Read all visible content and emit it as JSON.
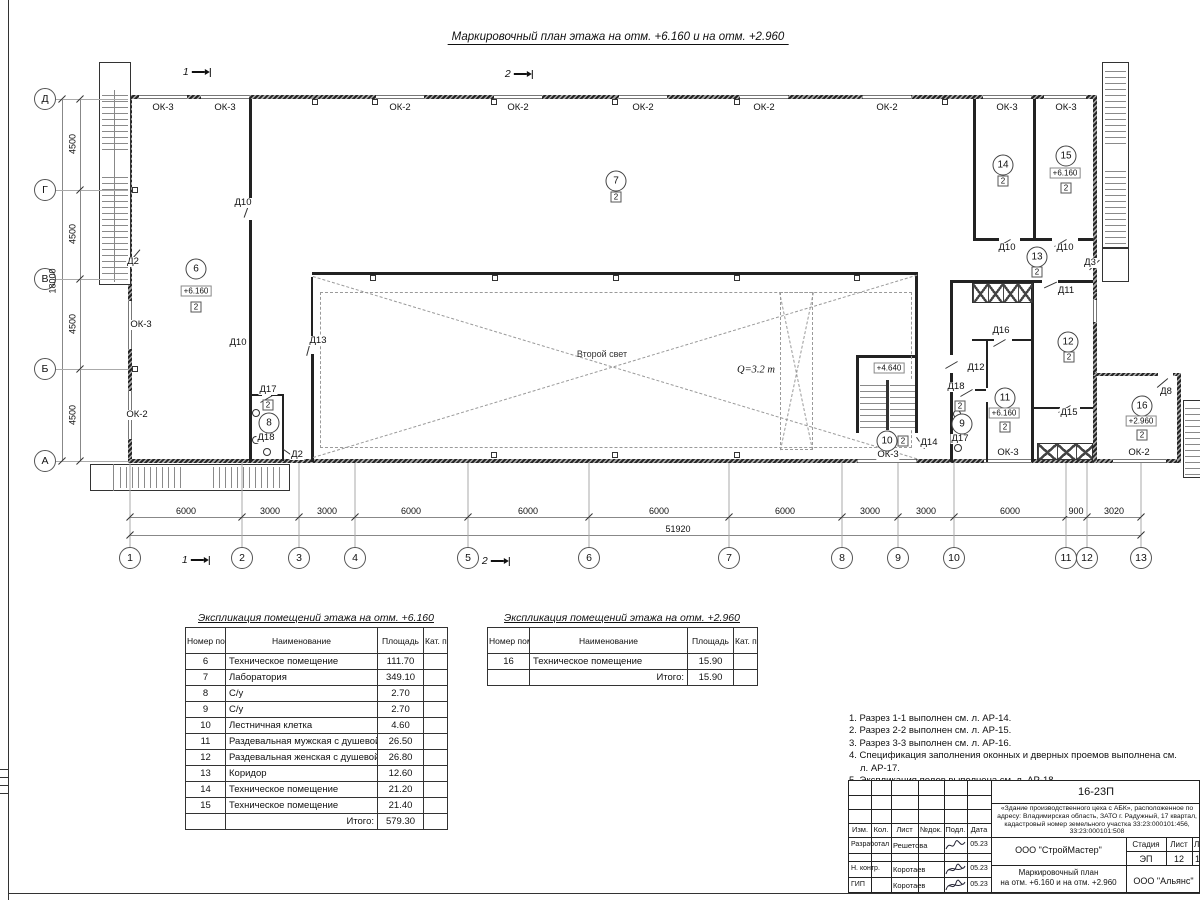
{
  "title": "Маркировочный план этажа на отм. +6.160 и на отм. +2.960",
  "colors": {
    "ink": "#1a1a1a",
    "thin_line": "#888",
    "dashed": "#9a9a9a"
  },
  "plan": {
    "col_axes": [
      {
        "label": "1",
        "x": 130
      },
      {
        "label": "2",
        "x": 242
      },
      {
        "label": "3",
        "x": 299
      },
      {
        "label": "4",
        "x": 355
      },
      {
        "label": "5",
        "x": 468
      },
      {
        "label": "6",
        "x": 589
      },
      {
        "label": "7",
        "x": 729
      },
      {
        "label": "8",
        "x": 842
      },
      {
        "label": "9",
        "x": 898
      },
      {
        "label": "10",
        "x": 954
      },
      {
        "label": "11",
        "x": 1066
      },
      {
        "label": "12",
        "x": 1087
      },
      {
        "label": "13",
        "x": 1141
      }
    ],
    "row_axes": [
      {
        "label": "Д",
        "y": 99
      },
      {
        "label": "Г",
        "y": 190
      },
      {
        "label": "В",
        "y": 279
      },
      {
        "label": "Б",
        "y": 369
      },
      {
        "label": "А",
        "y": 461
      }
    ],
    "dims_bottom": [
      {
        "text": "6000",
        "x": 186
      },
      {
        "text": "3000",
        "x": 270
      },
      {
        "text": "3000",
        "x": 327
      },
      {
        "text": "6000",
        "x": 411
      },
      {
        "text": "6000",
        "x": 528
      },
      {
        "text": "6000",
        "x": 659
      },
      {
        "text": "6000",
        "x": 785
      },
      {
        "text": "3000",
        "x": 870
      },
      {
        "text": "3000",
        "x": 926
      },
      {
        "text": "6000",
        "x": 1010
      },
      {
        "text": "900",
        "x": 1076
      },
      {
        "text": "3020",
        "x": 1114
      }
    ],
    "dim_total": {
      "text": "51920",
      "x": 678
    },
    "dims_left": [
      {
        "text": "4500",
        "y": 144
      },
      {
        "text": "4500",
        "y": 234
      },
      {
        "text": "4500",
        "y": 324
      },
      {
        "text": "4500",
        "y": 415
      }
    ],
    "dim_left_total": {
      "text": "18000",
      "y": 281
    },
    "window_labels": [
      {
        "t": "ОК-3",
        "x": 163,
        "y": 108
      },
      {
        "t": "ОК-3",
        "x": 225,
        "y": 108
      },
      {
        "t": "ОК-2",
        "x": 400,
        "y": 108
      },
      {
        "t": "ОК-2",
        "x": 518,
        "y": 108
      },
      {
        "t": "ОК-2",
        "x": 643,
        "y": 108
      },
      {
        "t": "ОК-2",
        "x": 764,
        "y": 108
      },
      {
        "t": "ОК-2",
        "x": 887,
        "y": 108
      },
      {
        "t": "ОК-3",
        "x": 1007,
        "y": 108
      },
      {
        "t": "ОК-3",
        "x": 1066,
        "y": 108
      },
      {
        "t": "ОК-3",
        "x": 141,
        "y": 325
      },
      {
        "t": "ОК-2",
        "x": 137,
        "y": 415
      },
      {
        "t": "ОК-3",
        "x": 888,
        "y": 455
      },
      {
        "t": "ОК-3",
        "x": 1008,
        "y": 453
      },
      {
        "t": "ОК-2",
        "x": 1139,
        "y": 453
      }
    ],
    "door_labels": [
      {
        "t": "Д2",
        "x": 133,
        "y": 262
      },
      {
        "t": "Д10",
        "x": 243,
        "y": 203
      },
      {
        "t": "Д10",
        "x": 238,
        "y": 343
      },
      {
        "t": "Д13",
        "x": 318,
        "y": 341
      },
      {
        "t": "Д17",
        "x": 268,
        "y": 390
      },
      {
        "t": "Д18",
        "x": 266,
        "y": 438
      },
      {
        "t": "Д2",
        "x": 297,
        "y": 455
      },
      {
        "t": "Д14",
        "x": 929,
        "y": 443
      },
      {
        "t": "Д18",
        "x": 956,
        "y": 387
      },
      {
        "t": "Д17",
        "x": 960,
        "y": 439
      },
      {
        "t": "Д12",
        "x": 976,
        "y": 368
      },
      {
        "t": "Д16",
        "x": 1001,
        "y": 331
      },
      {
        "t": "Д11",
        "x": 1066,
        "y": 291
      },
      {
        "t": "Д10",
        "x": 1007,
        "y": 248
      },
      {
        "t": "Д10",
        "x": 1065,
        "y": 248
      },
      {
        "t": "Д3",
        "x": 1090,
        "y": 263
      },
      {
        "t": "Д15",
        "x": 1069,
        "y": 413
      },
      {
        "t": "Д8",
        "x": 1166,
        "y": 392
      }
    ],
    "rooms": [
      {
        "num": "6",
        "x": 196,
        "y": 269,
        "elev": "+6.160",
        "ex": 196,
        "ey": 291,
        "note": "2",
        "nx": 196,
        "ny": 307
      },
      {
        "num": "7",
        "x": 616,
        "y": 181,
        "note": "2",
        "nx": 616,
        "ny": 197
      },
      {
        "num": "8",
        "x": 269,
        "y": 423,
        "note": "2",
        "nx": 268,
        "ny": 405
      },
      {
        "num": "9",
        "x": 962,
        "y": 424,
        "note": "2",
        "nx": 960,
        "ny": 406
      },
      {
        "num": "10",
        "x": 887,
        "y": 441,
        "note": "2",
        "nx": 903,
        "ny": 441
      },
      {
        "num": "11",
        "x": 1005,
        "y": 398,
        "elev": "+6.160",
        "ex": 1004,
        "ey": 413,
        "note": "2",
        "nx": 1005,
        "ny": 427
      },
      {
        "num": "12",
        "x": 1068,
        "y": 342,
        "note": "2",
        "nx": 1069,
        "ny": 357
      },
      {
        "num": "13",
        "x": 1037,
        "y": 257,
        "note": "2",
        "nx": 1037,
        "ny": 272
      },
      {
        "num": "14",
        "x": 1003,
        "y": 165,
        "note": "2",
        "nx": 1003,
        "ny": 181
      },
      {
        "num": "15",
        "x": 1066,
        "y": 156,
        "elev": "+6.160",
        "ex": 1065,
        "ey": 173,
        "note": "2",
        "nx": 1066,
        "ny": 188
      },
      {
        "num": "16",
        "x": 1142,
        "y": 406,
        "elev": "+2.960",
        "ex": 1141,
        "ey": 421,
        "note": "2",
        "nx": 1142,
        "ny": 435
      }
    ],
    "texts": [
      {
        "t": "Второй свет",
        "x": 602,
        "y": 354,
        "cls": "ptxt"
      },
      {
        "t": "Q=3.2 т",
        "x": 756,
        "y": 370,
        "cls": "pq"
      },
      {
        "t": "+4.640",
        "x": 889,
        "y": 368,
        "cls": "relev"
      }
    ],
    "sections": [
      {
        "t": "1",
        "x": 197,
        "y": 72
      },
      {
        "t": "2",
        "x": 519,
        "y": 74
      },
      {
        "t": "1",
        "x": 196,
        "y": 560
      },
      {
        "t": "2",
        "x": 496,
        "y": 561
      }
    ]
  },
  "tables": [
    {
      "title": "Экспликация помещений этажа на отм. +6.160",
      "headers": [
        "Номер помещ.",
        "Наименование",
        "Площадь",
        "Кат. пом."
      ],
      "rows": [
        [
          "6",
          "Техническое помещение",
          "111.70"
        ],
        [
          "7",
          "Лаборатория",
          "349.10"
        ],
        [
          "8",
          "С/у",
          "2.70"
        ],
        [
          "9",
          "С/у",
          "2.70"
        ],
        [
          "10",
          "Лестничная клетка",
          "4.60"
        ],
        [
          "11",
          "Раздевальная мужская с душевой",
          "26.50"
        ],
        [
          "12",
          "Раздевальная женская с душевой",
          "26.80"
        ],
        [
          "13",
          "Коридор",
          "12.60"
        ],
        [
          "14",
          "Техническое помещение",
          "21.20"
        ],
        [
          "15",
          "Техническое помещение",
          "21.40"
        ]
      ],
      "total_label": "Итого:",
      "total": "579.30"
    },
    {
      "title": "Экспликация помещений этажа на отм. +2.960",
      "headers": [
        "Номер помещ.",
        "Наименование",
        "Площадь",
        "Кат. пом."
      ],
      "rows": [
        [
          "16",
          "Техническое помещение",
          "15.90"
        ]
      ],
      "total_label": "Итого:",
      "total": "15.90"
    }
  ],
  "notes": [
    "1. Разрез 1-1 выполнен см. л. АР-14.",
    "2. Разрез 2-2 выполнен см. л. АР-15.",
    "3. Разрез 3-3 выполнен см. л. АР-16.",
    "4. Спецификация заполнения оконных и дверных проемов выполнена см. л. АР-17.",
    "5. Экспликация полов выполнена см. л. АР-18."
  ],
  "title_block": {
    "doc_no": "16-23П",
    "description": "«Здание производственного цеха с АБК», расположенное по адресу: Владимирская область, ЗАТО г. Радужный, 17 квартал, кадастровый номер земельного участка 33:23:000101:456, 33:23:000101:508",
    "cols": [
      "Изм.",
      "Кол.",
      "Лист",
      "№док.",
      "Подл.",
      "Дата"
    ],
    "people": [
      {
        "role": "Разработал",
        "name": "Решетова",
        "date": "05.23"
      },
      {
        "role": "Н. контр.",
        "name": "Коротаев",
        "date": "05.23"
      },
      {
        "role": "ГИП",
        "name": "Коротаев",
        "date": "05.23"
      }
    ],
    "org": "ООО \"СтройМастер\"",
    "stage_label": "Стадия",
    "stage": "ЭП",
    "sheet_label": "Лист",
    "sheet": "12",
    "sheets_label": "Лис",
    "sheets": "1",
    "subtitle": "Маркировочный план\nна отм. +6.160 и на отм. +2.960",
    "org2": "ООО \"Альянс\""
  }
}
